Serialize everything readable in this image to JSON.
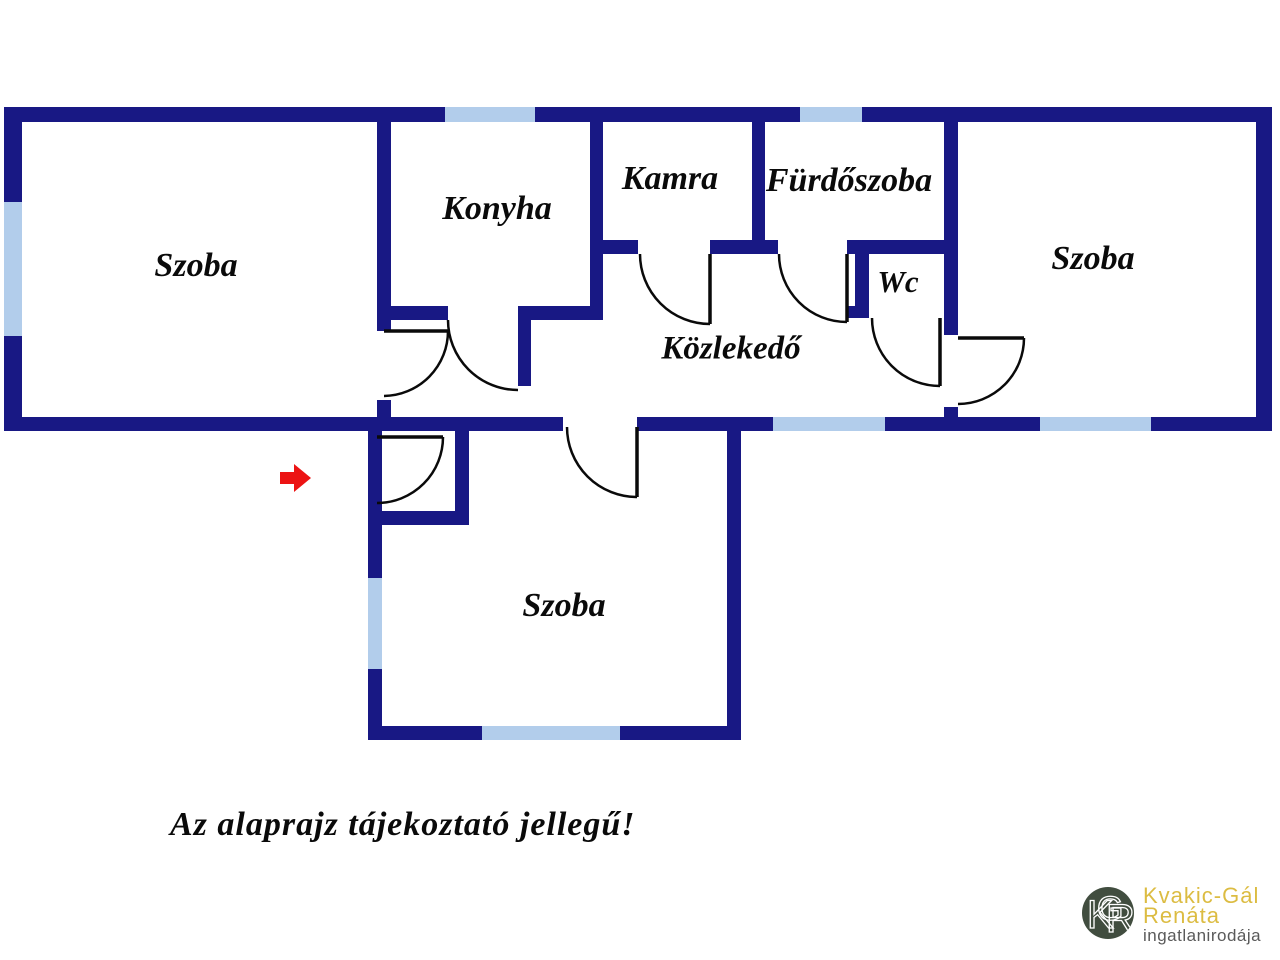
{
  "disclaimer": "Az alaprajz tájekoztató jellegű!",
  "logo": {
    "monogram": [
      "K",
      "G",
      "R"
    ],
    "name_line1": "Kvakic-Gál",
    "name_line2": "Renáta",
    "subtitle": "ingatlanirodája",
    "colors": {
      "circle": "#414d3f",
      "monogram": "#ffffff",
      "name": "#dcbc42",
      "subtitle": "#5a5a5a"
    }
  },
  "floorplan": {
    "colors": {
      "wall": "#181884",
      "window": "#b2cdeb",
      "door": "#0a0a0a",
      "label": "#0a0a0a",
      "arrow": "#ec1313"
    },
    "rooms": [
      {
        "id": "szoba-left",
        "label": "Szoba",
        "x": 196,
        "y": 268,
        "size": 34
      },
      {
        "id": "konyha",
        "label": "Konyha",
        "x": 497,
        "y": 211,
        "size": 34
      },
      {
        "id": "kamra",
        "label": "Kamra",
        "x": 670,
        "y": 181,
        "size": 34
      },
      {
        "id": "furdoszoba",
        "label": "Fürdőszoba",
        "x": 849,
        "y": 183,
        "size": 34
      },
      {
        "id": "wc",
        "label": "Wc",
        "x": 898,
        "y": 285,
        "size": 31
      },
      {
        "id": "kozlekedo",
        "label": "Közlekedő",
        "x": 731,
        "y": 351,
        "size": 33
      },
      {
        "id": "szoba-right",
        "label": "Szoba",
        "x": 1093,
        "y": 261,
        "size": 34
      },
      {
        "id": "szoba-bottom",
        "label": "Szoba",
        "x": 564,
        "y": 608,
        "size": 34
      }
    ],
    "walls": [
      {
        "id": "top-wall-a",
        "x": 4,
        "y": 107,
        "w": 441,
        "h": 15
      },
      {
        "id": "top-wall-b",
        "x": 535,
        "y": 107,
        "w": 265,
        "h": 15
      },
      {
        "id": "top-wall-c",
        "x": 862,
        "y": 107,
        "w": 410,
        "h": 15
      },
      {
        "id": "left-outer-wall-a",
        "x": 4,
        "y": 107,
        "w": 18,
        "h": 95
      },
      {
        "id": "left-outer-wall-b",
        "x": 4,
        "y": 336,
        "w": 18,
        "h": 95
      },
      {
        "id": "right-outer-wall",
        "x": 1256,
        "y": 107,
        "w": 16,
        "h": 324
      },
      {
        "id": "band-bottom-wall-a",
        "x": 4,
        "y": 417,
        "w": 559,
        "h": 14
      },
      {
        "id": "band-bottom-wall-b",
        "x": 637,
        "y": 417,
        "w": 136,
        "h": 14
      },
      {
        "id": "band-bottom-wall-c",
        "x": 885,
        "y": 417,
        "w": 155,
        "h": 14
      },
      {
        "id": "band-bottom-wall-d",
        "x": 1151,
        "y": 417,
        "w": 121,
        "h": 14
      },
      {
        "id": "szoba-konyha-divider-a",
        "x": 377,
        "y": 107,
        "w": 14,
        "h": 224
      },
      {
        "id": "szoba-konyha-divider-b",
        "x": 377,
        "y": 400,
        "w": 14,
        "h": 31
      },
      {
        "id": "konyha-bottom-wall-a",
        "x": 377,
        "y": 306,
        "w": 71,
        "h": 14
      },
      {
        "id": "konyha-bottom-wall-b",
        "x": 518,
        "y": 306,
        "w": 85,
        "h": 14
      },
      {
        "id": "konyha-door-leaf-stub",
        "x": 518,
        "y": 320,
        "w": 13,
        "h": 66
      },
      {
        "id": "konyha-kamra-divider",
        "x": 590,
        "y": 107,
        "w": 13,
        "h": 213
      },
      {
        "id": "kamra-bottom-wall-a",
        "x": 603,
        "y": 240,
        "w": 35,
        "h": 14
      },
      {
        "id": "kamra-bottom-wall-b",
        "x": 710,
        "y": 240,
        "w": 68,
        "h": 14
      },
      {
        "id": "wc-top-wall",
        "x": 847,
        "y": 240,
        "w": 110,
        "h": 14
      },
      {
        "id": "kamra-furdo-divider",
        "x": 752,
        "y": 107,
        "w": 13,
        "h": 147
      },
      {
        "id": "wc-left-wall",
        "x": 855,
        "y": 240,
        "w": 14,
        "h": 78
      },
      {
        "id": "wc-bottom-stub",
        "x": 846,
        "y": 306,
        "w": 23,
        "h": 12
      },
      {
        "id": "furdo-szoba-divider-a",
        "x": 944,
        "y": 107,
        "w": 14,
        "h": 228
      },
      {
        "id": "furdo-szoba-divider-b",
        "x": 944,
        "y": 407,
        "w": 14,
        "h": 24
      },
      {
        "id": "bottom-left-wall-a",
        "x": 368,
        "y": 431,
        "w": 14,
        "h": 147
      },
      {
        "id": "bottom-left-wall-b",
        "x": 368,
        "y": 669,
        "w": 14,
        "h": 71
      },
      {
        "id": "vestibule-right-wall",
        "x": 455,
        "y": 417,
        "w": 14,
        "h": 98
      },
      {
        "id": "vestibule-bottom-wall",
        "x": 368,
        "y": 511,
        "w": 101,
        "h": 14
      },
      {
        "id": "bottom-szoba-bottom-a",
        "x": 368,
        "y": 726,
        "w": 114,
        "h": 14
      },
      {
        "id": "bottom-szoba-bottom-b",
        "x": 620,
        "y": 726,
        "w": 121,
        "h": 14
      },
      {
        "id": "bottom-szoba-right",
        "x": 727,
        "y": 417,
        "w": 14,
        "h": 323
      }
    ],
    "windows": [
      {
        "id": "window-top-konyha",
        "x": 445,
        "y": 107,
        "w": 90,
        "h": 15
      },
      {
        "id": "window-top-furdoszoba",
        "x": 800,
        "y": 107,
        "w": 62,
        "h": 15
      },
      {
        "id": "window-left-szoba",
        "x": 4,
        "y": 202,
        "w": 18,
        "h": 134
      },
      {
        "id": "window-band-bottom-mid",
        "x": 773,
        "y": 417,
        "w": 112,
        "h": 14
      },
      {
        "id": "window-band-bottom-right",
        "x": 1040,
        "y": 417,
        "w": 111,
        "h": 14
      },
      {
        "id": "window-bottom-szoba-left",
        "x": 368,
        "y": 578,
        "w": 14,
        "h": 91
      },
      {
        "id": "window-bottom-szoba-low",
        "x": 482,
        "y": 726,
        "w": 138,
        "h": 14
      }
    ],
    "doors": [
      {
        "id": "konyha-door",
        "leaf": null,
        "arc": {
          "sx": 448,
          "sy": 320,
          "r": 70,
          "ex": 518,
          "ey": 390,
          "sweep": 0
        }
      },
      {
        "id": "szoba-left-door",
        "leaf": {
          "x1": 384,
          "y1": 331,
          "x2": 448,
          "y2": 331
        },
        "arc": {
          "sx": 448,
          "sy": 331,
          "r": 65,
          "ex": 384,
          "ey": 396,
          "sweep": 1
        }
      },
      {
        "id": "entrance-door",
        "leaf": {
          "x1": 377,
          "y1": 437,
          "x2": 443,
          "y2": 437
        },
        "arc": {
          "sx": 443,
          "sy": 437,
          "r": 66,
          "ex": 377,
          "ey": 503,
          "sweep": 1
        }
      },
      {
        "id": "szoba-bottom-door",
        "leaf": {
          "x1": 637,
          "y1": 427,
          "x2": 637,
          "y2": 497
        },
        "arc": {
          "sx": 567,
          "sy": 427,
          "r": 70,
          "ex": 637,
          "ey": 497,
          "sweep": 0
        }
      },
      {
        "id": "kamra-door",
        "leaf": {
          "x1": 710,
          "y1": 254,
          "x2": 710,
          "y2": 324
        },
        "arc": {
          "sx": 640,
          "sy": 254,
          "r": 70,
          "ex": 710,
          "ey": 324,
          "sweep": 0
        }
      },
      {
        "id": "furdoszoba-door",
        "leaf": {
          "x1": 847,
          "y1": 254,
          "x2": 847,
          "y2": 322
        },
        "arc": {
          "sx": 779,
          "sy": 254,
          "r": 68,
          "ex": 847,
          "ey": 322,
          "sweep": 0
        }
      },
      {
        "id": "wc-door",
        "leaf": {
          "x1": 940,
          "y1": 318,
          "x2": 940,
          "y2": 386
        },
        "arc": {
          "sx": 872,
          "sy": 318,
          "r": 68,
          "ex": 940,
          "ey": 386,
          "sweep": 0
        }
      },
      {
        "id": "szoba-right-door",
        "leaf": {
          "x1": 958,
          "y1": 338,
          "x2": 1024,
          "y2": 338
        },
        "arc": {
          "sx": 1024,
          "sy": 338,
          "r": 66,
          "ex": 958,
          "ey": 404,
          "sweep": 1
        }
      }
    ],
    "entrance_arrow": {
      "points": "280,472 294,472 294,464 311,478 294,492 294,484 280,484"
    }
  }
}
